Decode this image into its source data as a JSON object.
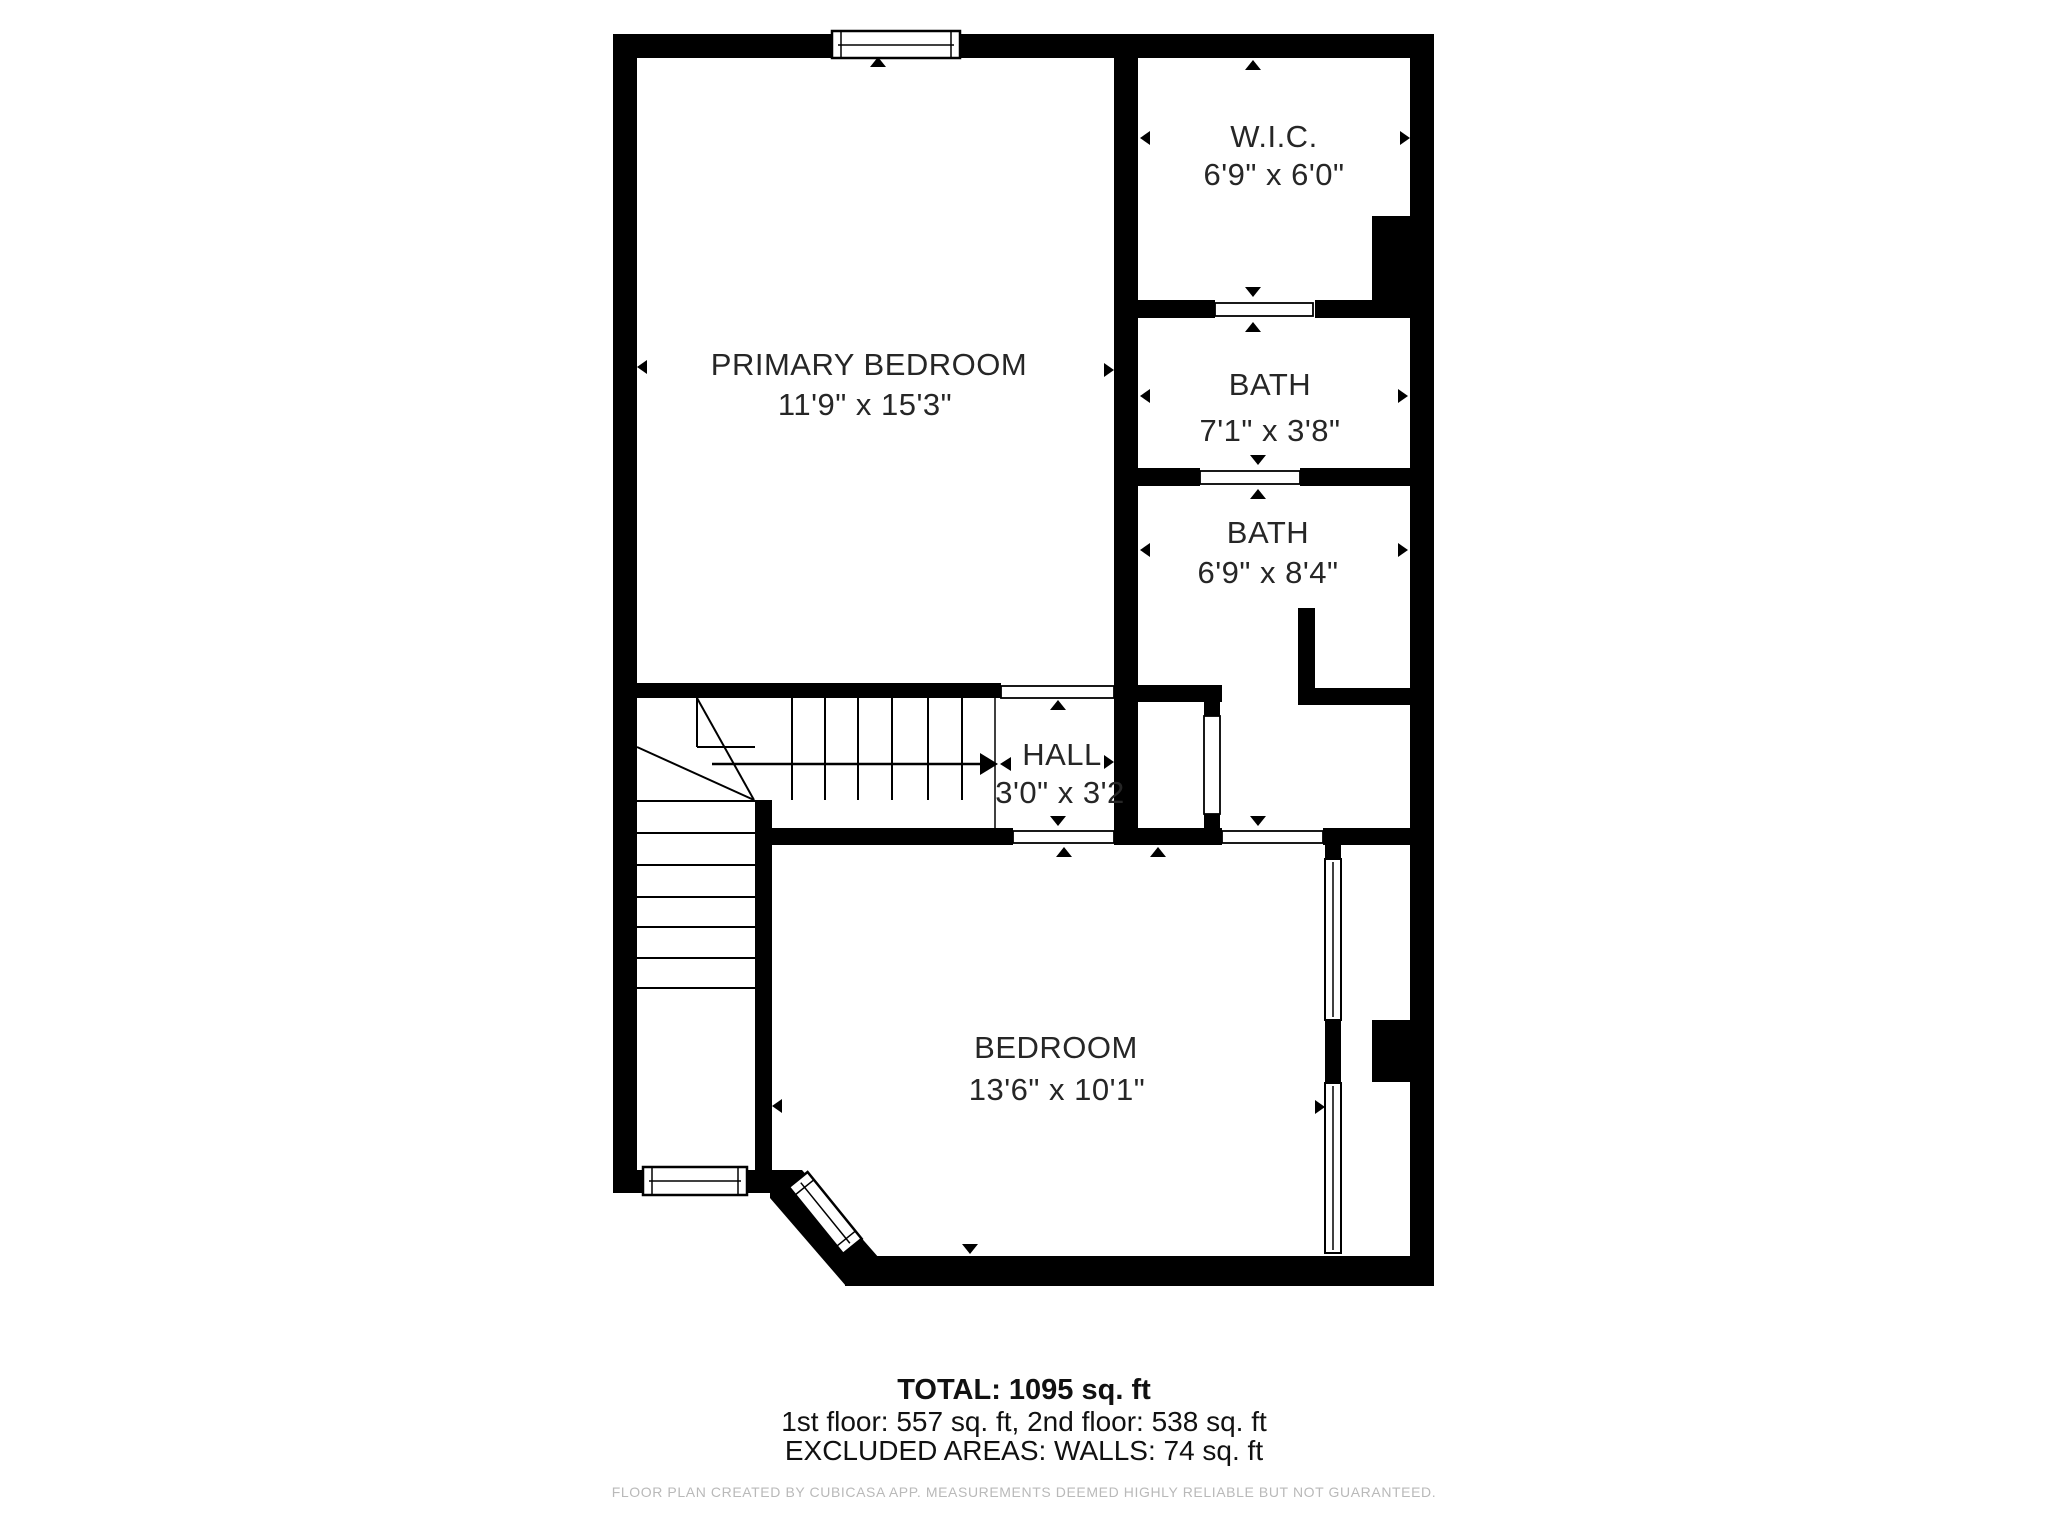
{
  "rooms": {
    "primary_bedroom": {
      "name": "PRIMARY BEDROOM",
      "dims": "11'9\" x 15'3\""
    },
    "wic": {
      "name": "W.I.C.",
      "dims": "6'9\" x 6'0\""
    },
    "bath_upper": {
      "name": "BATH",
      "dims": "7'1\" x 3'8\""
    },
    "bath_lower": {
      "name": "BATH",
      "dims": "6'9\" x 8'4\""
    },
    "hall": {
      "name": "HALL",
      "dims": "3'0\" x 3'2"
    },
    "bedroom": {
      "name": "BEDROOM",
      "dims": "13'6\" x 10'1\""
    }
  },
  "summary": {
    "total": "TOTAL: 1095 sq. ft",
    "floors": "1st floor: 557 sq. ft, 2nd floor: 538 sq. ft",
    "excluded": "EXCLUDED AREAS: WALLS: 74 sq. ft"
  },
  "footer": {
    "disclaimer": "FLOOR PLAN CREATED BY CUBICASA APP. MEASUREMENTS DEEMED HIGHLY RELIABLE BUT NOT GUARANTEED."
  },
  "colors": {
    "wall": "#000000",
    "text": "#262626",
    "disclaimer": "#b9b9b9"
  }
}
